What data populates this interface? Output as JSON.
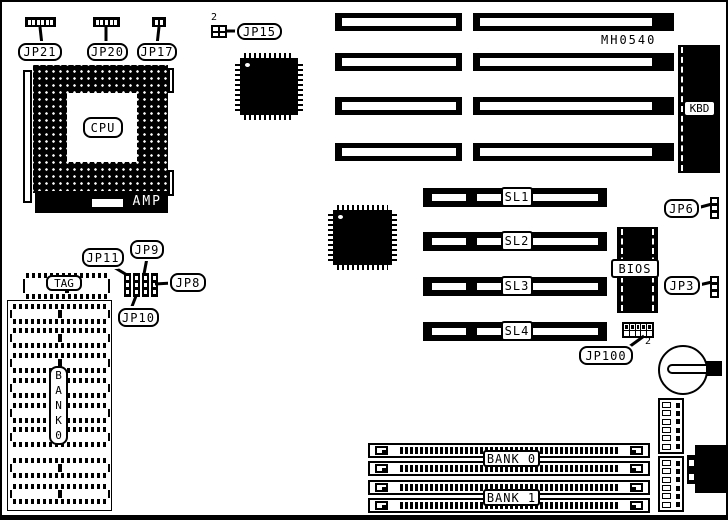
{
  "board": {
    "model": "MH0540"
  },
  "cpu": {
    "label": "CPU",
    "amp": "AMP"
  },
  "top_jumpers": {
    "jp21": "JP21",
    "jp20": "JP20",
    "jp17": "JP17",
    "jp15": "JP15",
    "jp15_pin": "2"
  },
  "kbd": {
    "label": "KBD"
  },
  "sl_slots": {
    "sl1": "SL1",
    "sl2": "SL2",
    "sl3": "SL3",
    "sl4": "SL4"
  },
  "bios": {
    "label": "BIOS"
  },
  "right_jumpers": {
    "jp6": "JP6",
    "jp3": "JP3",
    "jp100": "JP100",
    "jp100_pin": "2"
  },
  "cache": {
    "tag": "TAG",
    "bank0_vertical": "B\nA\nN\nK\n0"
  },
  "mid_jumpers": {
    "jp11": "JP11",
    "jp9": "JP9",
    "jp8": "JP8",
    "jp10": "JP10"
  },
  "memory": {
    "bank0": "BANK 0",
    "bank1": "BANK 1"
  }
}
